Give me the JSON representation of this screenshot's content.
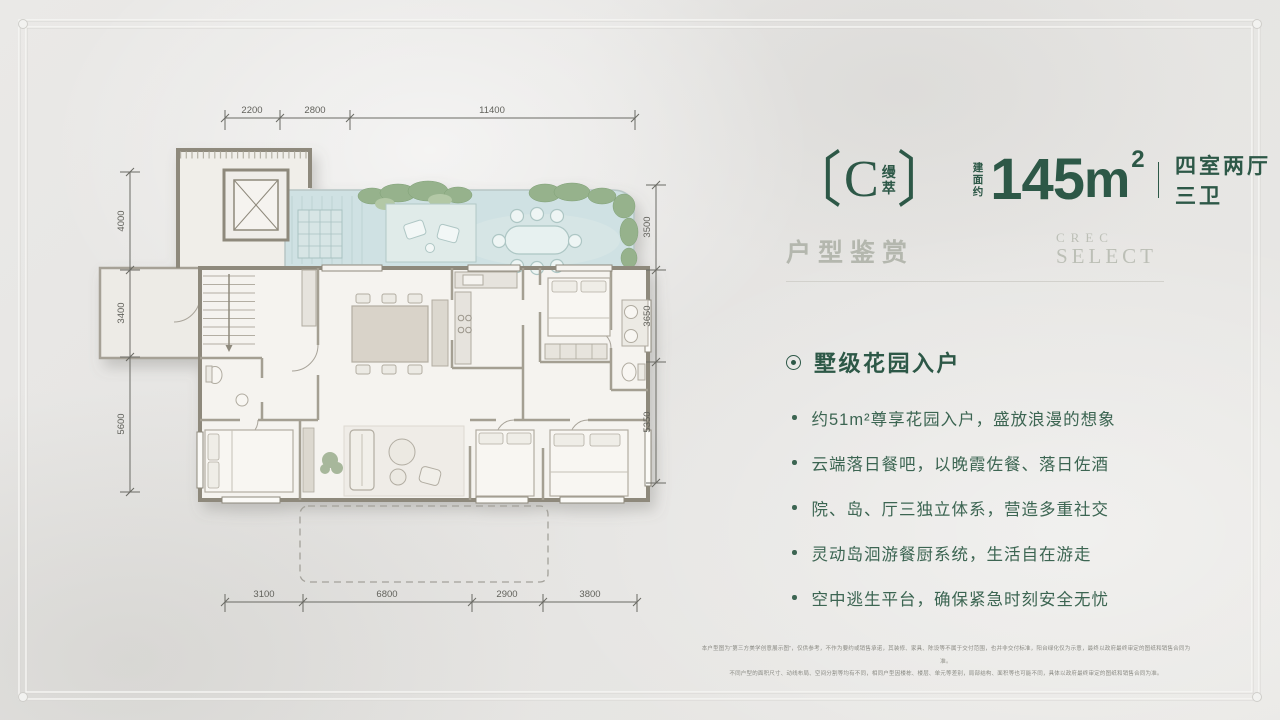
{
  "colors": {
    "accent_green": "#2d5847",
    "muted_green": "#b4b7ae",
    "garden_blue": "#cfe1e3"
  },
  "header": {
    "bracket_left": "〔",
    "unit_letter": "C",
    "unit_name_char1": "缦",
    "unit_name_char2": "萃",
    "bracket_right": "〕",
    "area_prefix_char1": "建",
    "area_prefix_char2": "面",
    "area_prefix_char3": "约",
    "area_value": "145",
    "area_unit": "m",
    "area_sup": "2",
    "layout_label": "四室两厅三卫"
  },
  "subheader": {
    "title": "户型鉴赏",
    "brand_top": "CREC",
    "brand_bottom": "SELECT"
  },
  "features": {
    "heading": "墅级花园入户",
    "items": [
      "约51m²尊享花园入户，盛放浪漫的想象",
      "云端落日餐吧，以晚霞佐餐、落日佐酒",
      "院、岛、厅三独立体系，营造多重社交",
      "灵动岛洄游餐厨系统，生活自在游走",
      "空中逃生平台，确保紧急时刻安全无忧"
    ]
  },
  "disclaimer": {
    "line1": "本户型图为“第三方美学创意展示图”，仅供参考，不作为要约或销售承诺，其装修、家具、陈设等不属于交付范围，也并非交付标准，阳台绿化仅为示意，最终以政府最终审定的图纸和销售合同为准。",
    "line2": "不同户型的面积尺寸、动线布局、空间分割等均有不同，相同户型因楼栋、楼层、单元等差别，局部结构、面积等也可能不同，具体以政府最终审定的图纸和销售合同为准。"
  },
  "floorplan": {
    "dims_top": [
      "2200",
      "2800",
      "11400"
    ],
    "dims_left": [
      "4000",
      "3400",
      "5600"
    ],
    "dims_right": [
      "3500",
      "3650",
      "5350"
    ],
    "dims_bottom": [
      "3100",
      "6800",
      "2900",
      "3800"
    ]
  }
}
